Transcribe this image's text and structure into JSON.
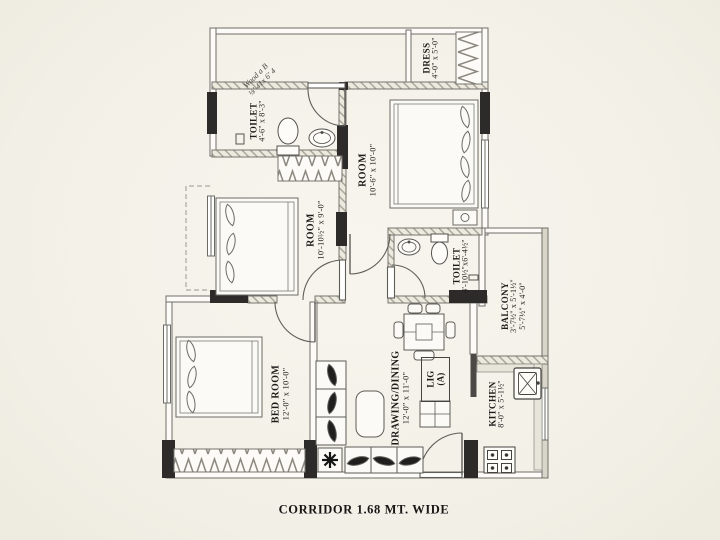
{
  "plan_title": "apartment-floor-plan",
  "colors": {
    "paper": "#f4f2e9",
    "ink": "#1d1c1a",
    "wall_fill": "#fcfbf7",
    "wall_black": "#2c2b29",
    "hatch": "#a19d90"
  },
  "rooms": {
    "toilet_top": {
      "name": "TOILET",
      "dims": "4'-6\" x 8'-3\""
    },
    "dress": {
      "name": "DRESS",
      "dims": "4'-0\" x 5'-0\""
    },
    "room_right": {
      "name": "ROOM",
      "dims": "10'-6\" x 10'-0\""
    },
    "room_left": {
      "name": "ROOM",
      "dims": "10'-10½\" x 9'-0\""
    },
    "toilet_mid": {
      "name": "TOILET",
      "dims": "4'-10½\"x6'-4½\""
    },
    "balcony": {
      "name": "BALCONY",
      "dims_a": "3'-7½\" x 5'-1½\"",
      "dims_b": "5'-7½\" x 4'-0\""
    },
    "bed_room": {
      "name": "BED ROOM",
      "dims": "12'-0\" x 10'-0\""
    },
    "drawing_dining": {
      "name": "DRAWING/DINING",
      "dims": "12'-0\" x 11'-0\""
    },
    "kitchen": {
      "name": "KITCHEN",
      "dims": "8'-0\" x 5'-1½\""
    },
    "unit_tag": {
      "line1": "LIG",
      "line2": "(A)"
    }
  },
  "annotations": {
    "corridor": "CORRIDOR 1.68 MT. WIDE",
    "pencil_line1": "Wood a B",
    "pencil_line2": "⅛' 41x 6' 4"
  }
}
